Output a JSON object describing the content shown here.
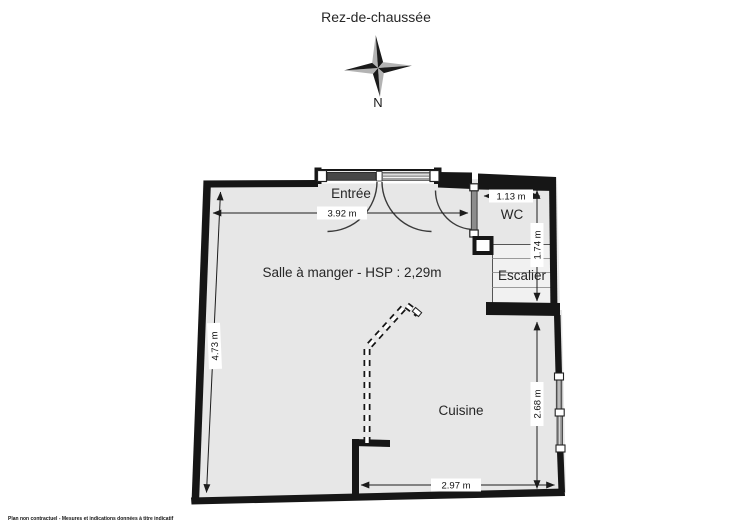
{
  "title": "Rez-de-chaussée",
  "compass": {
    "north_label": "N"
  },
  "rooms": {
    "entree": "Entrée",
    "wc": "WC",
    "escalier": "Escalier",
    "salle_a_manger": "Salle à manger - HSP : 2,29m",
    "cuisine": "Cuisine"
  },
  "dimensions": {
    "entrance_width": "3.92 m",
    "left_wall_height": "4.73 m",
    "wc_width": "1.13 m",
    "wc_escalier_depth": "1.74 m",
    "cuisine_depth": "2.68 m",
    "cuisine_width": "2.97 m"
  },
  "footer_disclaimer": "Plan non contractuel - Mesures et indications données à titre indicatif",
  "colors": {
    "wall": "#161616",
    "floor": "#e7e7e7",
    "door_leaf": "#8c8c8c",
    "compass_gray": "#b3b3b3"
  }
}
